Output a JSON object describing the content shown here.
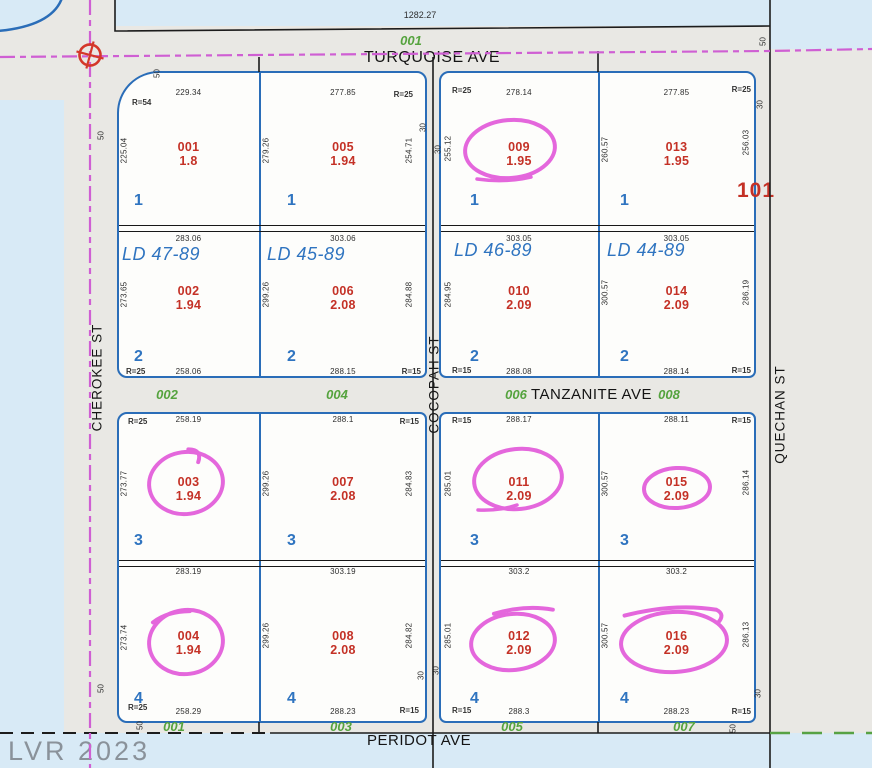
{
  "watermark": "LVR 2023",
  "parcel_label": "101",
  "boundary_dim": "1282.27",
  "corner_radius_nw": "R=54",
  "streets": {
    "north": "TURQUOISE AVE",
    "middle": "TANZANITE AVE",
    "south": "PERIDOT AVE",
    "west": "CHEROKEE ST",
    "center": "COCOPAH ST",
    "east": "QUECHAN ST"
  },
  "road_labels": {
    "turquoise": "001",
    "tanzanite": [
      "002",
      "004",
      "006",
      "008"
    ],
    "peridot": [
      "001",
      "003",
      "005",
      "007"
    ]
  },
  "markers": {
    "fifty": "50",
    "thirty": "30"
  },
  "ld_labels": [
    "LD 47-89",
    "LD 45-89",
    "LD 46-89",
    "LD 44-89"
  ],
  "colors": {
    "lot_text_red": "#c43126",
    "block_text_blue": "#2f74c0",
    "road_label_green": "#55a33e",
    "annotation_magenta": "#e156d9",
    "centerline_magenta": "#cf5fd3",
    "street_gray": "#e9e8e4",
    "background_blue": "#d8eaf6",
    "lot_border_blue": "#2a6db8"
  },
  "lots": [
    {
      "id": "001",
      "area": "1.8",
      "block": "1",
      "dim_top": "229.34",
      "dim_left": "225.04",
      "r_tl": "R=54",
      "circled": false
    },
    {
      "id": "005",
      "area": "1.94",
      "block": "1",
      "dim_top": "277.85",
      "dim_left": "279.26",
      "dim_right": "254.71",
      "r_tr": "R=25",
      "circled": false
    },
    {
      "id": "009",
      "area": "1.95",
      "block": "1",
      "dim_top": "278.14",
      "dim_left": "255.12",
      "r_tl": "R=25",
      "circled": true
    },
    {
      "id": "013",
      "area": "1.95",
      "block": "1",
      "dim_top": "277.85",
      "dim_left": "260.57",
      "dim_right": "256.03",
      "r_tr": "R=25",
      "circled": false
    },
    {
      "id": "002",
      "area": "1.94",
      "block": "2",
      "ld": "LD 47-89",
      "dim_top": "283.06",
      "dim_left": "273.65",
      "dim_bottom": "258.06",
      "r_bl": "R=25",
      "circled": false
    },
    {
      "id": "006",
      "area": "2.08",
      "block": "2",
      "ld": "LD 45-89",
      "dim_top": "303.06",
      "dim_left": "299.26",
      "dim_right": "284.88",
      "dim_bottom": "288.15",
      "r_br": "R=15",
      "circled": false
    },
    {
      "id": "010",
      "area": "2.09",
      "block": "2",
      "ld": "LD 46-89",
      "dim_top": "303.05",
      "dim_left": "284.95",
      "dim_bottom": "288.08",
      "r_bl": "R=15",
      "circled": false
    },
    {
      "id": "014",
      "area": "2.09",
      "block": "2",
      "ld": "LD 44-89",
      "dim_top": "303.05",
      "dim_left": "300.57",
      "dim_right": "286.19",
      "dim_bottom": "288.14",
      "r_br": "R=15",
      "circled": false
    },
    {
      "id": "003",
      "area": "1.94",
      "block": "3",
      "dim_top": "258.19",
      "dim_left": "273.77",
      "r_tl": "R=25",
      "circled": true
    },
    {
      "id": "007",
      "area": "2.08",
      "block": "3",
      "dim_top": "288.1",
      "dim_left": "299.26",
      "dim_right": "284.83",
      "r_tr": "R=15",
      "circled": false
    },
    {
      "id": "011",
      "area": "2.09",
      "block": "3",
      "dim_top": "288.17",
      "dim_left": "285.01",
      "r_tl": "R=15",
      "circled": true
    },
    {
      "id": "015",
      "area": "2.09",
      "block": "3",
      "dim_top": "288.11",
      "dim_left": "300.57",
      "dim_right": "286.14",
      "r_tr": "R=15",
      "circled": true
    },
    {
      "id": "004",
      "area": "1.94",
      "block": "4",
      "dim_top": "283.19",
      "dim_left": "273.74",
      "dim_bottom": "258.29",
      "r_bl": "R=25",
      "circled": true
    },
    {
      "id": "008",
      "area": "2.08",
      "block": "4",
      "dim_top": "303.19",
      "dim_left": "299.26",
      "dim_right": "284.82",
      "dim_bottom": "288.23",
      "r_br": "R=15",
      "circled": false
    },
    {
      "id": "012",
      "area": "2.09",
      "block": "4",
      "dim_top": "303.2",
      "dim_left": "285.01",
      "dim_bottom": "288.3",
      "r_bl": "R=15",
      "circled": true
    },
    {
      "id": "016",
      "area": "2.09",
      "block": "4",
      "dim_top": "303.2",
      "dim_left": "300.57",
      "dim_right": "286.13",
      "dim_bottom": "288.23",
      "r_br": "R=15",
      "circled": true
    }
  ]
}
